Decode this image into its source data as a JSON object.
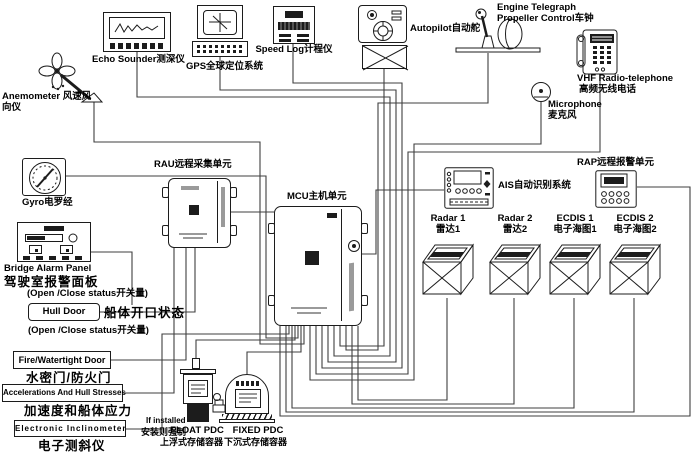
{
  "colors": {
    "wire": "#3f3f3f",
    "ink": "#1c1c1c",
    "background": "#ffffff"
  },
  "labels": {
    "echo": "Echo Sounder测深仪",
    "gps": "GPS全球定位系统",
    "speed_log": "Speed Log计程仪",
    "autopilot": "Autopilot自动舵",
    "telegraph1": "Engine Telegraph",
    "telegraph2": "Propeller Control车钟",
    "vhf1": "VHF Radio-telephone",
    "vhf2": "高频无线电话",
    "mic1": "Microphone",
    "mic2": "麦克风",
    "anem1": "Anemometer 风速风",
    "anem2": "向仪",
    "gyro": "Gyro电罗经",
    "rau": "RAU远程采集单元",
    "mcu": "MCU主机单元",
    "bap1": "Bridge Alarm Panel",
    "bap2": "驾驶室报警面板",
    "bap3": "(Open /Close status开关量)",
    "hull": "Hull Door",
    "hull_zh": "船体开口状态",
    "hull_note": "(Open /Close status开关量)",
    "fire": "Fire/Watertight Door",
    "fire_zh": "水密门/防火门",
    "accel": "Accelerations And Hull Stresses",
    "accel_zh": "加速度和船体应力",
    "incl": "Electronic Inclinometer",
    "incl_zh": "电子测斜仪",
    "if1": "If installed",
    "if2": "安装则强制",
    "float1": "FLOAT PDC",
    "float2": "上浮式存储容器",
    "fixed1": "FIXED PDC",
    "fixed2": "下沉式存储容器",
    "ais": "AIS自动识别系统",
    "rap": "RAP远程报警单元",
    "radar1": "Radar 1",
    "radar1_zh": "雷达1",
    "radar2": "Radar 2",
    "radar2_zh": "雷达2",
    "ecdis1": "ECDIS 1",
    "ecdis1_zh": "电子海图1",
    "ecdis2": "ECDIS 2",
    "ecdis2_zh": "电子海图2"
  }
}
